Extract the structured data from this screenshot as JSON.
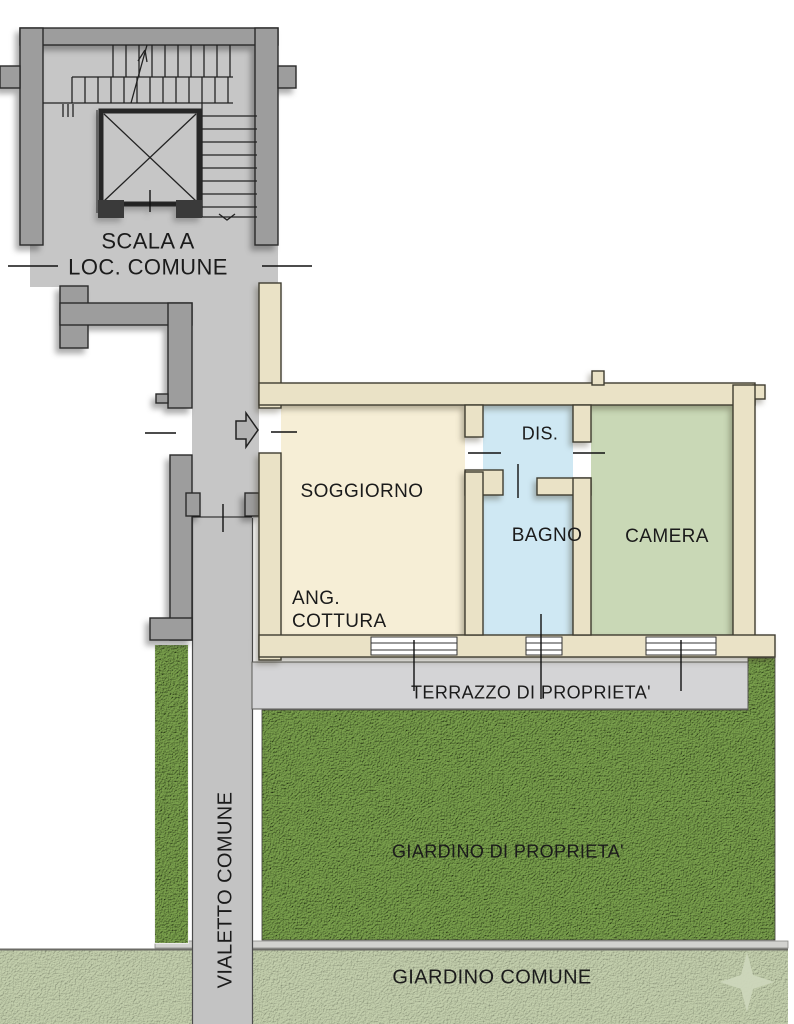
{
  "plan": {
    "stairwell": {
      "line1": "SCALA A",
      "line2": "LOC. COMUNE"
    },
    "rooms": {
      "soggiorno": "SOGGIORNO",
      "ang_cottura_line1": "ANG.",
      "ang_cottura_line2": "COTTURA",
      "dis": "DIS.",
      "bagno": "BAGNO",
      "camera": "CAMERA"
    },
    "outdoor": {
      "terrazzo": "TERRAZZO DI PROPRIETA'",
      "giardino_privato": "GIARDINO DI PROPRIETA'",
      "giardino_comune": "GIARDINO COMUNE",
      "vialetto": "VIALETTO COMUNE"
    },
    "icons": {
      "entrance_arrow": "right-arrow",
      "elevator": "elevator-shaft-x",
      "stairs_up_arrow": "stair-direction-arrow",
      "compass_star": "four-point-star"
    },
    "colors": {
      "floor_gray": "#c6c6c6",
      "wall_gray": "#9d9d9d",
      "wall_cream": "#eae2c6",
      "room_soggiorno": "#f6eed6",
      "room_bagno_dis": "#cfe8f3",
      "room_camera": "#c9d8b6",
      "terrace_gray": "#d4d4d6",
      "garden_green": "#6f9747",
      "garden_pale": "#b8c7a4",
      "line_dark": "#1c1c1c"
    }
  }
}
